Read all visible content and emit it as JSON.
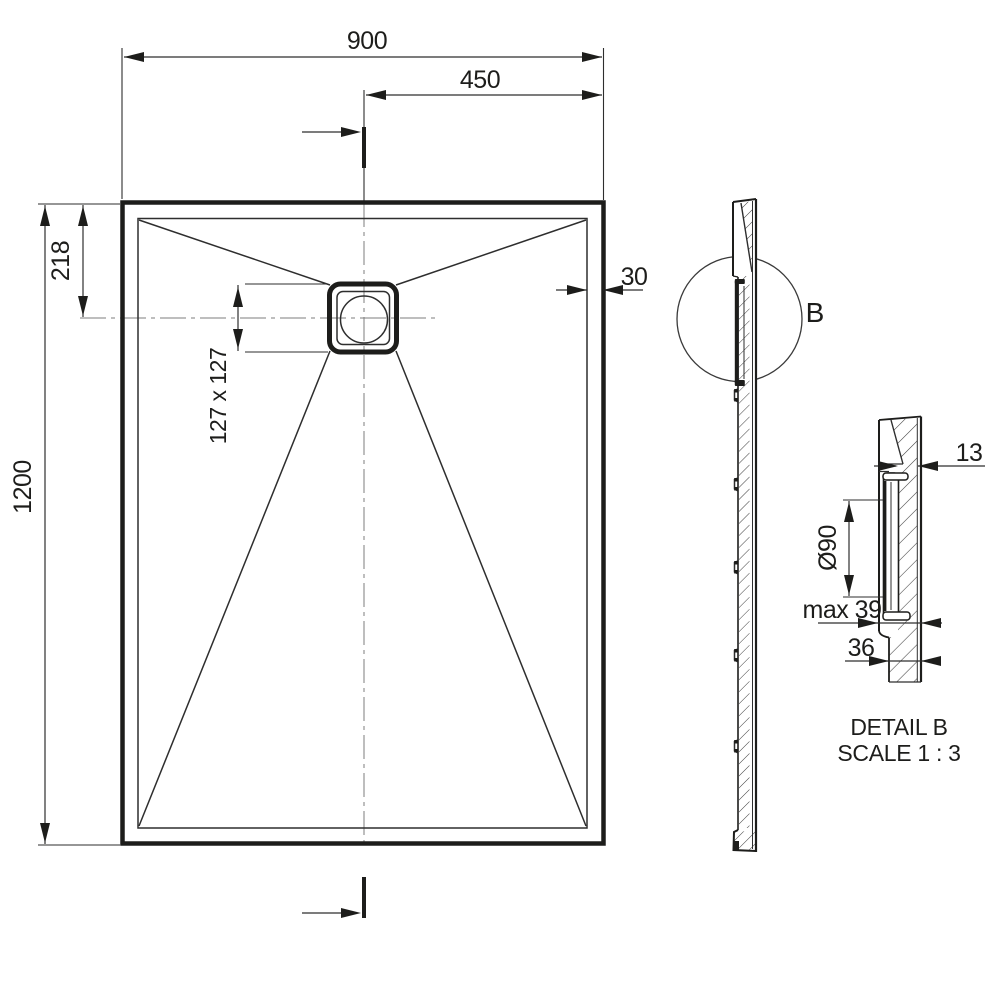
{
  "front_view": {
    "dim_total_width": "900",
    "dim_center_offset": "450",
    "dim_drain_top_offset": "218",
    "dim_total_height": "1200",
    "dim_drain_size": "127 x 127",
    "dim_edge_thickness": "30"
  },
  "side_view": {
    "detail_mark": "B"
  },
  "detail_view": {
    "dim_flange_depth": "13",
    "dim_drain_diameter": "Ø90",
    "dim_max_depth": "max 39",
    "dim_base_depth": "36",
    "title": "DETAIL B",
    "scale": "SCALE 1 : 3"
  },
  "colors": {
    "line": "#1d1d1b",
    "thin_line": "#2e2e2e",
    "centerline": "#7d7d7d",
    "background": "#ffffff"
  }
}
